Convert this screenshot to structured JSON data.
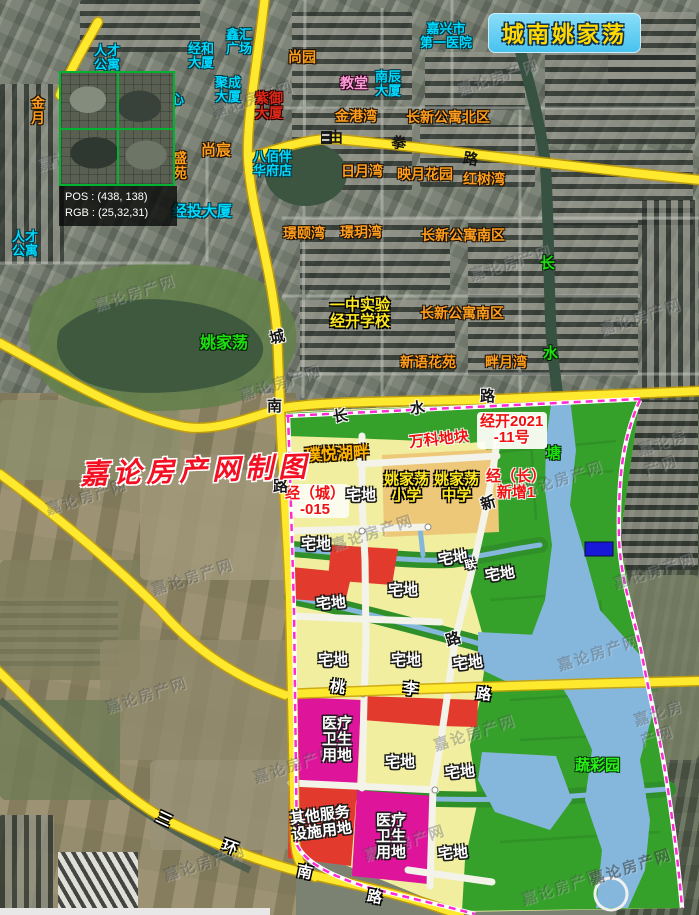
{
  "title": {
    "text": "城南姚家荡"
  },
  "magnifier": {
    "pos_label": "POS : (438, 138)",
    "rgb_label": "RGB : (25,32,31)"
  },
  "watermark": {
    "credit": "嘉论房产网制图",
    "tile_text": "嘉论房产网",
    "tiles": [
      {
        "x": 36,
        "y": 142
      },
      {
        "x": 210,
        "y": 88
      },
      {
        "x": 455,
        "y": 66
      },
      {
        "x": 92,
        "y": 282
      },
      {
        "x": 238,
        "y": 372
      },
      {
        "x": 468,
        "y": 252
      },
      {
        "x": 598,
        "y": 306
      },
      {
        "x": 44,
        "y": 486
      },
      {
        "x": 150,
        "y": 566
      },
      {
        "x": 330,
        "y": 522
      },
      {
        "x": 520,
        "y": 468
      },
      {
        "x": 612,
        "y": 560
      },
      {
        "x": 104,
        "y": 684
      },
      {
        "x": 252,
        "y": 754
      },
      {
        "x": 432,
        "y": 722
      },
      {
        "x": 556,
        "y": 642
      },
      {
        "x": 162,
        "y": 852
      },
      {
        "x": 362,
        "y": 832
      },
      {
        "x": 520,
        "y": 876
      },
      {
        "x": 588,
        "y": 856,
        "o": 0.5
      },
      {
        "x": 636,
        "y": 700
      },
      {
        "x": 640,
        "y": 430
      }
    ]
  },
  "colors": {
    "road_yellow": "#ffe92e",
    "boundary_magenta": "#ff2ad4",
    "zone_residential": "#f1ef9f",
    "zone_green": "#35a02a",
    "zone_school": "#eec879",
    "zone_red": "#e23b2e",
    "zone_medical": "#de149b",
    "water": "#85b7dd",
    "title_bg": "#5fd0f2",
    "title_text": "#ffd900",
    "label_cyan": "#00d9ff",
    "label_orange": "#ff9e1e",
    "label_green": "#1ee010"
  },
  "labels": [
    {
      "id": "label-rencai-gongyu-top",
      "text": "人才\n公寓",
      "cls": "c",
      "x": 94,
      "y": 44
    },
    {
      "id": "label-jinghe-dasha",
      "text": "经和\n大厦",
      "cls": "c",
      "x": 188,
      "y": 42
    },
    {
      "id": "label-xinhui-guangchang",
      "text": "鑫汇\n广场",
      "cls": "c",
      "x": 226,
      "y": 28
    },
    {
      "id": "label-jucheng-dasha",
      "text": "聚成\n大厦",
      "cls": "c",
      "x": 215,
      "y": 76
    },
    {
      "id": "label-nanchen-dasha",
      "text": "南辰\n大厦",
      "cls": "c",
      "x": 375,
      "y": 70
    },
    {
      "id": "label-jiaxing-diyi-yiyuan",
      "text": "嘉兴市\n第一医院",
      "cls": "c",
      "x": 420,
      "y": 22,
      "ctr": 1
    },
    {
      "id": "label-babaiban-huafudian",
      "text": "八佰伴\n华府店",
      "cls": "c",
      "x": 253,
      "y": 150
    },
    {
      "id": "label-jingtou-dasha",
      "text": "经投大厦",
      "cls": "c",
      "x": 172,
      "y": 204,
      "fs": 15
    },
    {
      "id": "label-rencai-gongyu-left",
      "text": "人才\n公寓",
      "cls": "c",
      "x": 12,
      "y": 230
    },
    {
      "id": "label-xin-partial",
      "text": "心",
      "cls": "c",
      "x": 171,
      "y": 93
    },
    {
      "id": "label-shangyuan",
      "text": "尚园",
      "cls": "o",
      "x": 288,
      "y": 50
    },
    {
      "id": "label-jingangwan",
      "text": "金港湾",
      "cls": "o",
      "x": 335,
      "y": 109
    },
    {
      "id": "label-changxin-gongyu-beiqu",
      "text": "长新公寓北区",
      "cls": "o",
      "x": 406,
      "y": 110
    },
    {
      "id": "label-riyuewan",
      "text": "日月湾",
      "cls": "o",
      "x": 341,
      "y": 164
    },
    {
      "id": "label-yingyue-huayuan",
      "text": "映月花园",
      "cls": "o",
      "x": 397,
      "y": 167
    },
    {
      "id": "label-hongshuwan",
      "text": "红树湾",
      "cls": "o",
      "x": 463,
      "y": 172
    },
    {
      "id": "label-shangchen",
      "text": "尚宸",
      "cls": "o",
      "x": 201,
      "y": 143,
      "fs": 15
    },
    {
      "id": "label-shengyuan",
      "text": "盛\n苑",
      "cls": "o",
      "x": 173,
      "y": 151
    },
    {
      "id": "label-jinyue-partial",
      "text": "金\n月",
      "cls": "o",
      "x": 31,
      "y": 96
    },
    {
      "id": "label-jingyiwan",
      "text": "璟颐湾",
      "cls": "o",
      "x": 283,
      "y": 226
    },
    {
      "id": "label-jingyuewan",
      "text": "璟玥湾",
      "cls": "o",
      "x": 340,
      "y": 225
    },
    {
      "id": "label-changxin-gongyu-nanqu-1",
      "text": "长新公寓南区",
      "cls": "o",
      "x": 421,
      "y": 228
    },
    {
      "id": "label-changxin-gongyu-nanqu-2",
      "text": "长新公寓南区",
      "cls": "o",
      "x": 420,
      "y": 306
    },
    {
      "id": "label-xinyu-huayuan",
      "text": "新语花苑",
      "cls": "o",
      "x": 400,
      "y": 355
    },
    {
      "id": "label-panyuewan",
      "text": "畔月湾",
      "cls": "o",
      "x": 485,
      "y": 355
    },
    {
      "id": "label-ziyu-dasha",
      "text": "紫御\n大厦",
      "cls": "dr",
      "x": 255,
      "y": 91
    },
    {
      "id": "label-jiaotang",
      "text": "教堂",
      "cls": "pk",
      "x": 340,
      "y": 76
    },
    {
      "id": "label-yizhong-shiyan",
      "text": "一中实验\n经开学校",
      "cls": "sy",
      "x": 330,
      "y": 298,
      "ctr": 1
    },
    {
      "id": "label-yaojiadang-xiaoxue",
      "text": "姚家荡\n小学",
      "cls": "sy",
      "x": 384,
      "y": 472,
      "ctr": 1
    },
    {
      "id": "label-yaojiadang-zhongxue",
      "text": "姚家荡\n中学",
      "cls": "sy",
      "x": 434,
      "y": 472,
      "ctr": 1
    },
    {
      "id": "label-yaojiadang-lake",
      "text": "姚家荡",
      "cls": "g",
      "x": 200,
      "y": 335,
      "fs": 16
    },
    {
      "id": "label-river-chang",
      "text": "长",
      "cls": "g",
      "x": 540,
      "y": 256
    },
    {
      "id": "label-river-shui",
      "text": "水",
      "cls": "g",
      "x": 543,
      "y": 346
    },
    {
      "id": "label-river-tang",
      "text": "塘",
      "cls": "g",
      "x": 546,
      "y": 446
    },
    {
      "id": "label-shucaiyuan",
      "text": "蔬彩园",
      "cls": "gb",
      "x": 575,
      "y": 758
    },
    {
      "id": "label-wanke-dikuai",
      "text": "万科地块",
      "cls": "pr",
      "x": 409,
      "y": 432,
      "rot": -6
    },
    {
      "id": "label-jingkai-2021-11",
      "text": "经开2021\n-11号",
      "cls": "pr",
      "x": 480,
      "y": 414,
      "ctr": 1
    },
    {
      "id": "label-jing-cheng-015",
      "text": "经（城）\n-015",
      "cls": "pr",
      "x": 285,
      "y": 486,
      "ctr": 1
    },
    {
      "id": "label-jing-chang-xinzeng1",
      "text": "经（长）\n新增1",
      "cls": "pr",
      "x": 486,
      "y": 469,
      "ctr": 1
    },
    {
      "id": "label-puyue-hupan",
      "text": "璞悦湖畔",
      "cls": "py",
      "x": 305,
      "y": 446,
      "rot": -3
    },
    {
      "id": "label-zhaidi-1",
      "text": "宅地",
      "cls": "zw",
      "x": 346,
      "y": 488
    },
    {
      "id": "label-zhaidi-2",
      "text": "宅地",
      "cls": "zw",
      "x": 301,
      "y": 537
    },
    {
      "id": "label-zhaidi-3",
      "text": "宅地",
      "cls": "zw",
      "x": 438,
      "y": 551,
      "rot": -8
    },
    {
      "id": "label-zhaidi-extra-char",
      "text": "联",
      "cls": "zw",
      "x": 465,
      "y": 560,
      "fs": 11,
      "rot": -12
    },
    {
      "id": "label-zhaidi-4",
      "text": "宅地",
      "cls": "zw",
      "x": 485,
      "y": 567,
      "rot": -8
    },
    {
      "id": "label-zhaidi-5",
      "text": "宅地",
      "cls": "zw",
      "x": 388,
      "y": 583
    },
    {
      "id": "label-zhaidi-6",
      "text": "宅地",
      "cls": "zw",
      "x": 316,
      "y": 596,
      "rot": -5
    },
    {
      "id": "label-zhaidi-7",
      "text": "宅地",
      "cls": "zw",
      "x": 318,
      "y": 653
    },
    {
      "id": "label-zhaidi-8",
      "text": "宅地",
      "cls": "zw",
      "x": 391,
      "y": 653
    },
    {
      "id": "label-zhaidi-9",
      "text": "宅地",
      "cls": "zw",
      "x": 453,
      "y": 656,
      "rot": -6
    },
    {
      "id": "label-zhaidi-10",
      "text": "宅地",
      "cls": "zw",
      "x": 385,
      "y": 755
    },
    {
      "id": "label-zhaidi-11",
      "text": "宅地",
      "cls": "zw",
      "x": 445,
      "y": 765,
      "rot": -5
    },
    {
      "id": "label-zhaidi-12",
      "text": "宅地",
      "cls": "zw",
      "x": 438,
      "y": 846,
      "rot": -5
    },
    {
      "id": "label-yiliao-weisheng-1",
      "text": "医疗\n卫生\n用地",
      "cls": "zw",
      "x": 322,
      "y": 716
    },
    {
      "id": "label-yiliao-weisheng-2",
      "text": "医疗\n卫生\n用地",
      "cls": "zw",
      "x": 376,
      "y": 813
    },
    {
      "id": "label-qita-fuwu-sheshi",
      "text": "其他服务\n设施用地",
      "cls": "zw",
      "x": 291,
      "y": 808,
      "rot": -7
    },
    {
      "id": "road-char-you",
      "text": "由",
      "cls": "rb",
      "x": 328,
      "y": 130
    },
    {
      "id": "road-char-quan",
      "text": "拳",
      "cls": "rb",
      "x": 391,
      "y": 136,
      "rot": 12
    },
    {
      "id": "road-char-lu-youquan",
      "text": "路",
      "cls": "rb",
      "x": 463,
      "y": 152,
      "rot": 10
    },
    {
      "id": "road-char-cheng",
      "text": "城",
      "cls": "rd",
      "x": 270,
      "y": 330,
      "rot": -14
    },
    {
      "id": "road-char-nan-chengnan",
      "text": "南",
      "cls": "rd",
      "x": 267,
      "y": 399
    },
    {
      "id": "road-char-lu-chengnan",
      "text": "路",
      "cls": "rd",
      "x": 273,
      "y": 479
    },
    {
      "id": "road-char-chang-changshui",
      "text": "长",
      "cls": "rd",
      "x": 333,
      "y": 409,
      "rot": -8
    },
    {
      "id": "road-char-shui-changshui",
      "text": "水",
      "cls": "rd",
      "x": 410,
      "y": 401,
      "rot": -6
    },
    {
      "id": "road-char-lu-changshui",
      "text": "路",
      "cls": "rd",
      "x": 480,
      "y": 389
    },
    {
      "id": "road-char-xin",
      "text": "新",
      "cls": "rd",
      "x": 481,
      "y": 496,
      "rot": -18
    },
    {
      "id": "road-char-lu-xin",
      "text": "路",
      "cls": "rd",
      "x": 446,
      "y": 632,
      "rot": -18
    },
    {
      "id": "road-char-tao",
      "text": "桃",
      "cls": "rw",
      "x": 330,
      "y": 680,
      "rot": 8
    },
    {
      "id": "road-char-li",
      "text": "李",
      "cls": "rw",
      "x": 403,
      "y": 682,
      "rot": 5
    },
    {
      "id": "road-char-lu-taoli",
      "text": "路",
      "cls": "rw",
      "x": 476,
      "y": 687,
      "rot": 5
    },
    {
      "id": "road-char-san",
      "text": "三",
      "cls": "rw",
      "x": 156,
      "y": 812,
      "rot": 25
    },
    {
      "id": "road-char-huan",
      "text": "环",
      "cls": "rw",
      "x": 222,
      "y": 840,
      "rot": 20
    },
    {
      "id": "road-char-nan-sanhuan",
      "text": "南",
      "cls": "rw",
      "x": 297,
      "y": 865,
      "rot": 12
    },
    {
      "id": "road-char-lu-sanhuan",
      "text": "路",
      "cls": "rw",
      "x": 367,
      "y": 890,
      "rot": 10
    }
  ]
}
